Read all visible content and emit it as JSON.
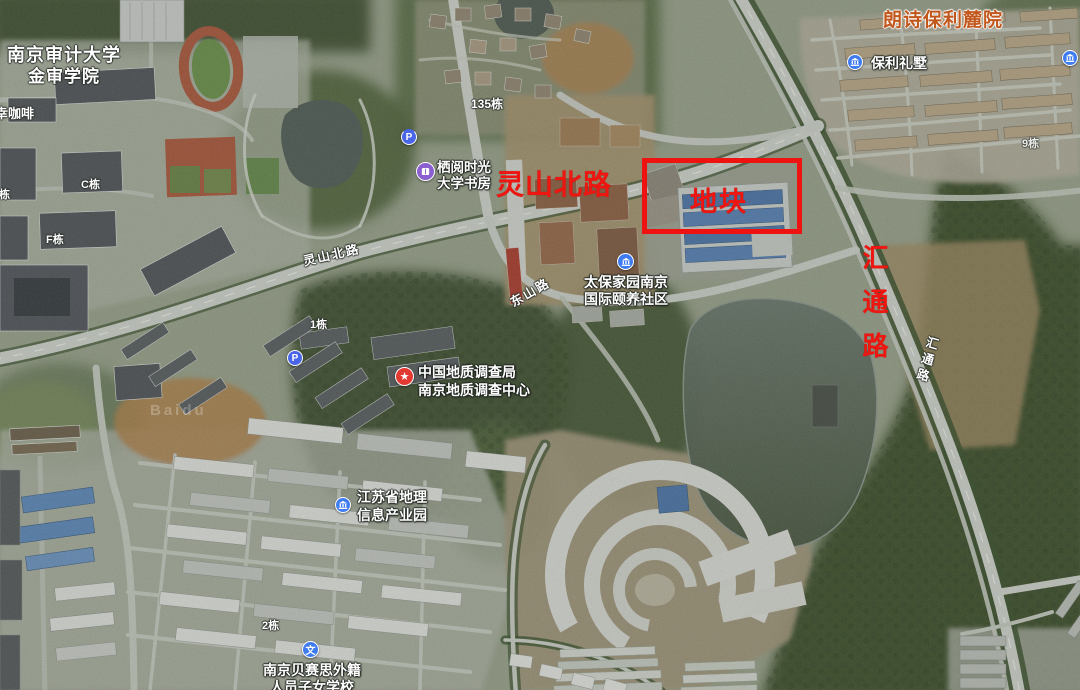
{
  "map": {
    "watermark": "Baidu",
    "red_annotations": {
      "parcel": "地块",
      "lingshan_road": "灵山北路",
      "huitong_road": "汇通路"
    },
    "aoi_labels": {
      "langshi_community": "朗诗保利麓院",
      "university_line1": "南京审计大学",
      "university_line2": "金审学院"
    },
    "pois": {
      "coffee": {
        "name": "幸咖啡"
      },
      "bookstore": {
        "line1": "栖阅时光",
        "line2": "大学书房"
      },
      "baoli_villa": {
        "name": "保利礼墅"
      },
      "taibao": {
        "line1": "太保家园南京",
        "line2": "国际颐养社区"
      },
      "geology_center": {
        "line1": "中国地质调查局",
        "line2": "南京地质调查中心"
      },
      "geo_info_park": {
        "line1": "江苏省地理",
        "line2": "信息产业园"
      },
      "basis_school": {
        "line1": "南京贝赛思外籍",
        "line2": "人员子女学校"
      },
      "parking_glyph": "P",
      "school_glyph": "文"
    },
    "building_labels": {
      "b135": "135栋",
      "b1": "1栋",
      "bC": "C栋",
      "bB": "B栋",
      "bF": "F栋",
      "b2": "2栋",
      "b9": "9栋"
    },
    "road_labels": {
      "lingshan": "灵山北路",
      "dongshan": "东山路",
      "huitong": "汇通路"
    },
    "colors": {
      "annotation_red": "#ee1610",
      "aoi_orange": "#c2571c",
      "poi_blue": "#3e7bf0",
      "poi_parking_blue": "#4a66e8",
      "poi_purple": "#8b5fd0",
      "poi_red": "#e23a33"
    }
  }
}
